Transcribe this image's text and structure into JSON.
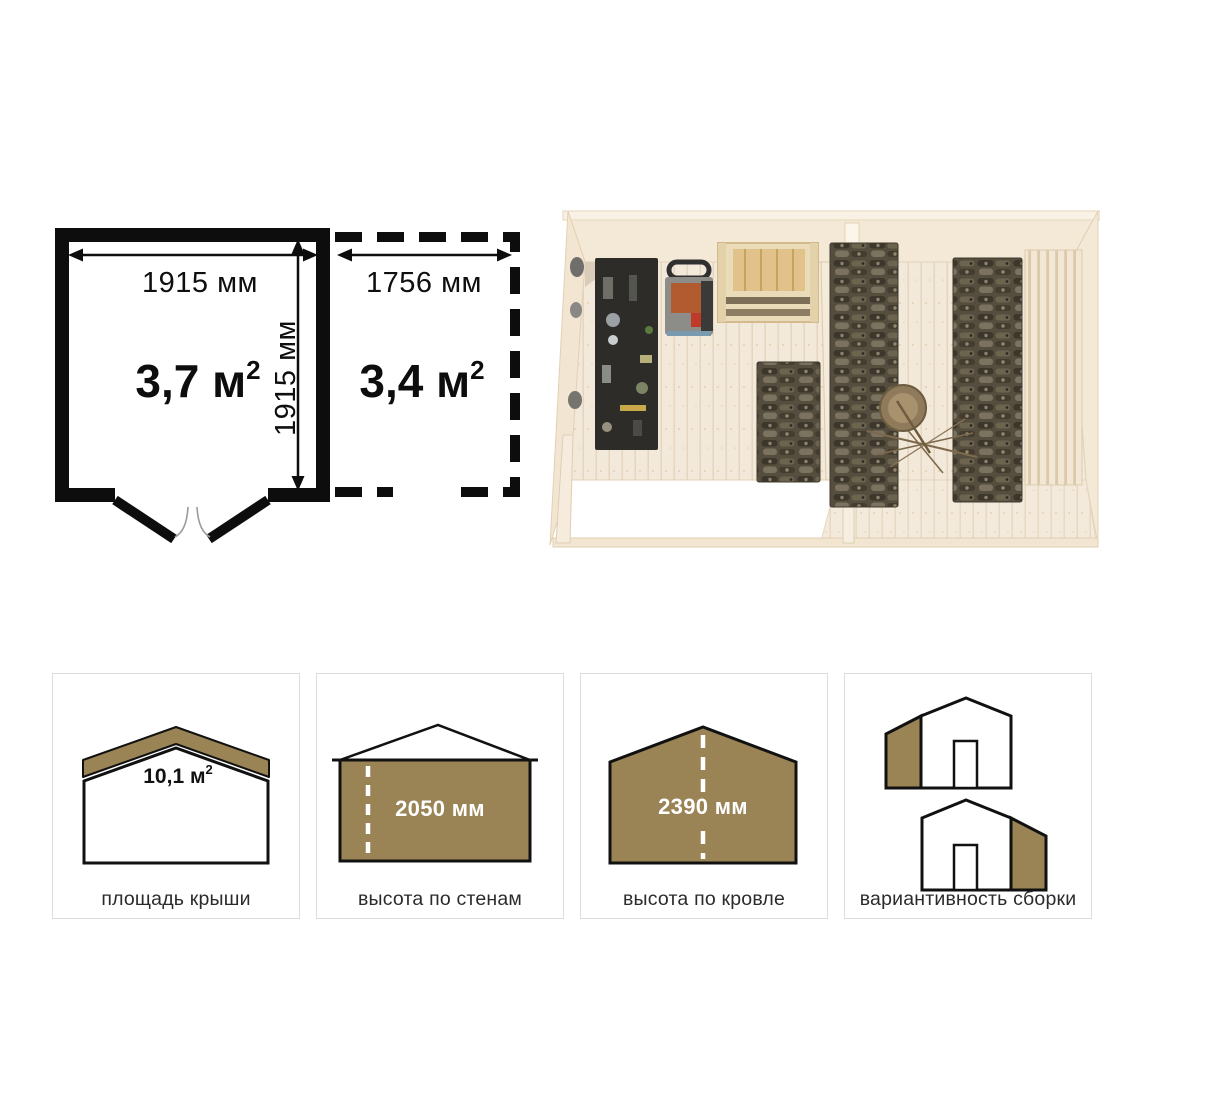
{
  "colors": {
    "accent_brown": "#9a8354",
    "outline_black": "#111111",
    "card_border": "#dcdcdc"
  },
  "floor_plan": {
    "main_room": {
      "width_label": "1915 мм",
      "depth_label": "1915 мм",
      "area_value": "3,7 м",
      "area_sup": "2"
    },
    "annex": {
      "width_label": "1756 мм",
      "area_value": "3,4 м",
      "area_sup": "2"
    }
  },
  "cards": [
    {
      "label": "площадь крыши",
      "value": "10,1 м",
      "value_sup": "2"
    },
    {
      "label": "высота по стенам",
      "value": "2050 мм"
    },
    {
      "label": "высота по кровле",
      "value": "2390 мм"
    },
    {
      "label": "вариантивность сборки"
    }
  ]
}
